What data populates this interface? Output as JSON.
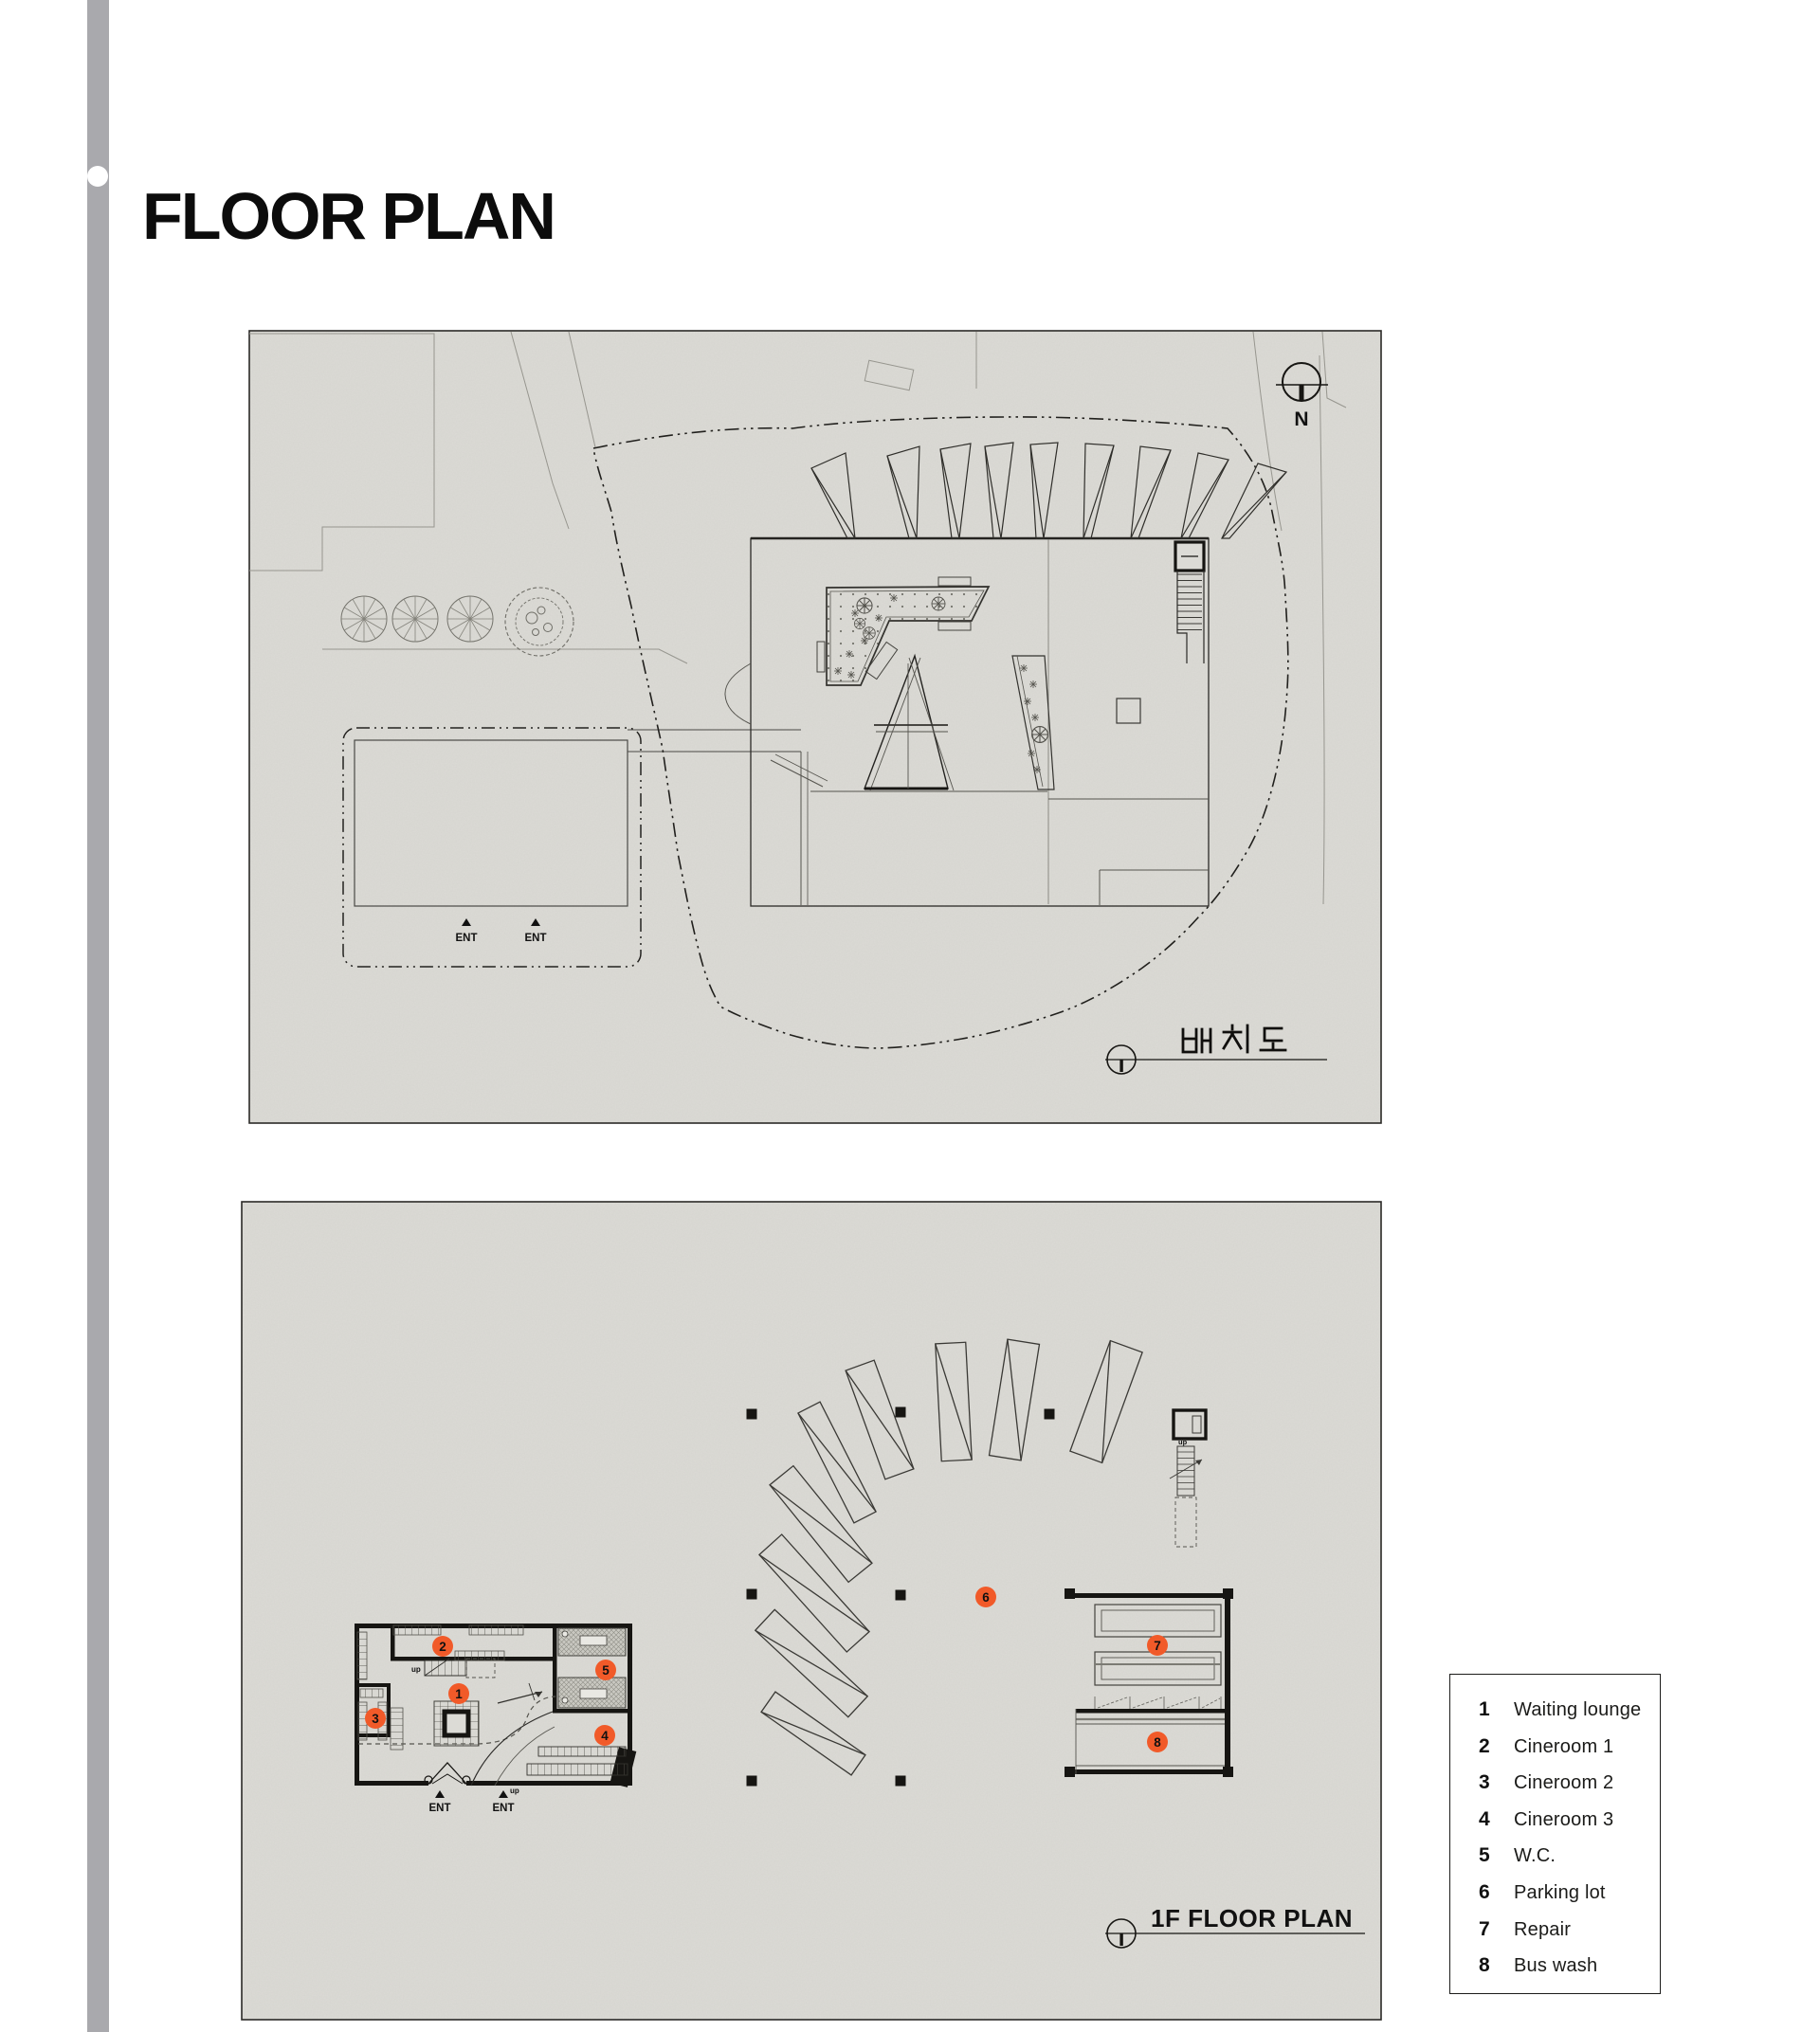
{
  "page": {
    "title": "FLOOR PLAN"
  },
  "accent_color": "#f15a29",
  "paper_color": "#dcdbd6",
  "site_plan": {
    "label_kr": "배치도",
    "north_label": "N",
    "ent_label": "ENT"
  },
  "floor_plan": {
    "label": "1F FLOOR PLAN",
    "ent_label": "ENT",
    "up_label": "up",
    "markers": [
      {
        "n": "1"
      },
      {
        "n": "2"
      },
      {
        "n": "3"
      },
      {
        "n": "4"
      },
      {
        "n": "5"
      },
      {
        "n": "6"
      },
      {
        "n": "7"
      },
      {
        "n": "8"
      }
    ]
  },
  "legend": {
    "items": [
      {
        "num": "1",
        "label": "Waiting lounge"
      },
      {
        "num": "2",
        "label": "Cineroom 1"
      },
      {
        "num": "3",
        "label": "Cineroom 2"
      },
      {
        "num": "4",
        "label": "Cineroom 3"
      },
      {
        "num": "5",
        "label": "W.C."
      },
      {
        "num": "6",
        "label": "Parking lot"
      },
      {
        "num": "7",
        "label": "Repair"
      },
      {
        "num": "8",
        "label": "Bus wash"
      }
    ]
  }
}
